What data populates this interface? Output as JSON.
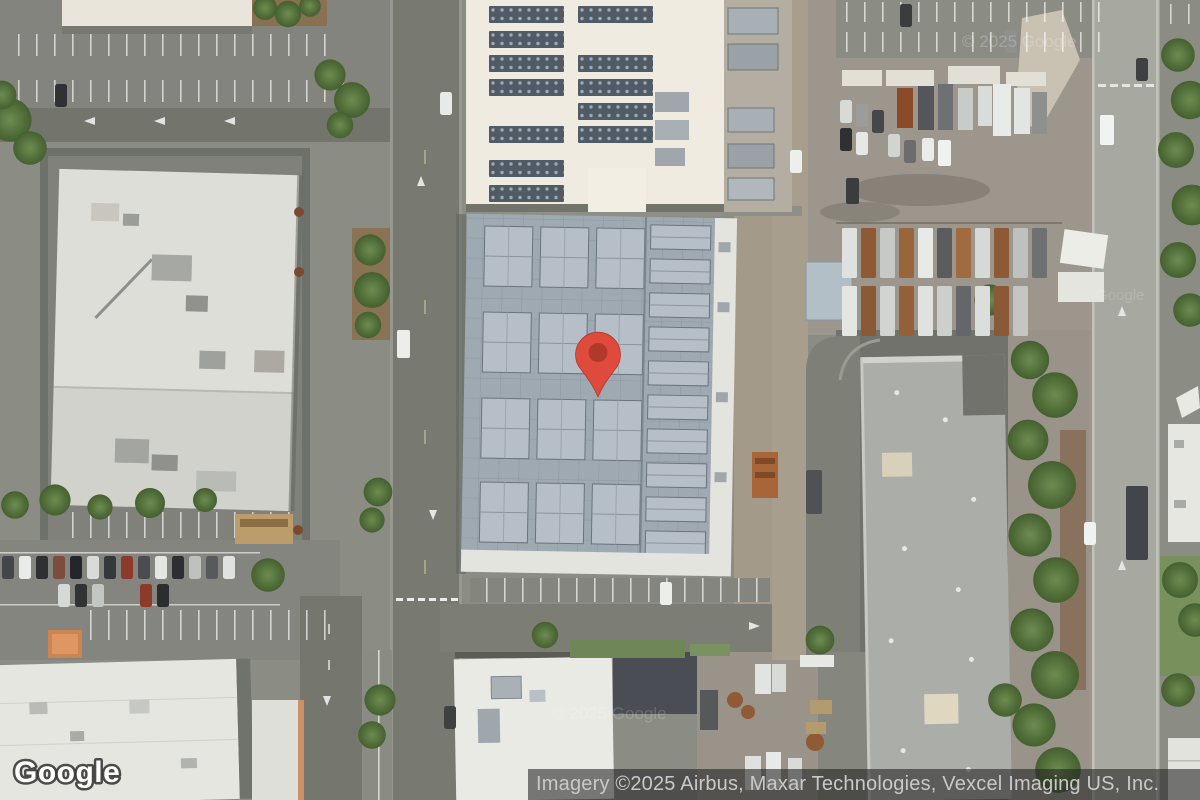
{
  "map": {
    "view_type": "satellite",
    "provider_logo": "Google",
    "attribution": "Imagery ©2025 Airbus, Maxar Technologies, Vexcel Imaging US, Inc.",
    "watermark_1": "© 2025 Google",
    "watermark_2": "© 2025 Google",
    "watermark_3": "Google",
    "marker": {
      "color": "#DE4A3B",
      "dot_color": "#B2382B"
    }
  }
}
